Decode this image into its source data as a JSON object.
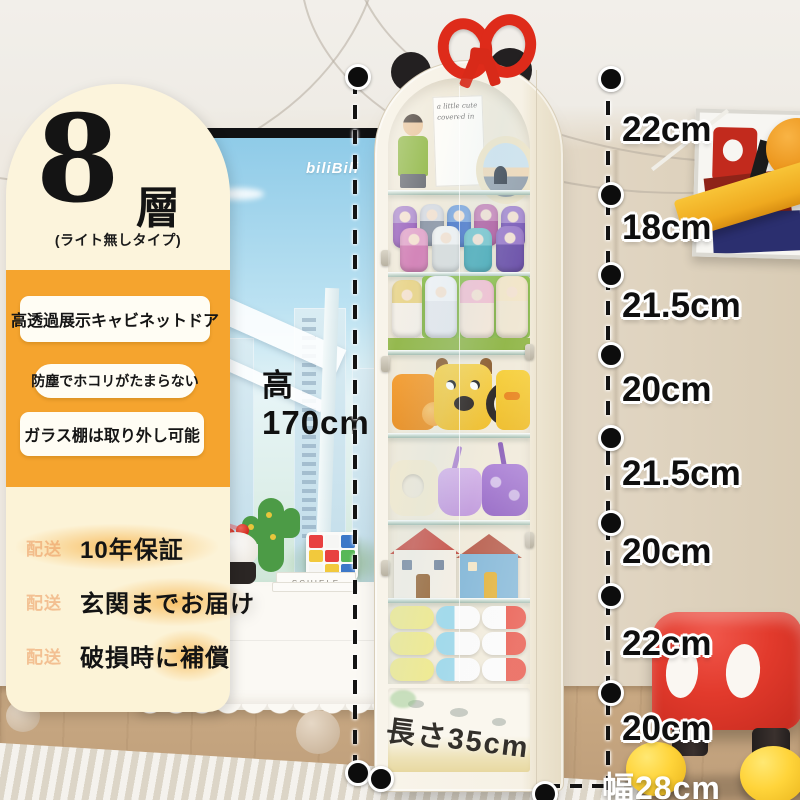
{
  "badge": {
    "tiers": "8層",
    "subtitle": "(ライト無しタイプ)"
  },
  "features": {
    "items": [
      {
        "label": "高透過展示キャビネットドア"
      },
      {
        "label": "防塵でホコリがたまらない"
      },
      {
        "label": "ガラス棚は取り外し可能"
      }
    ]
  },
  "services": {
    "items": [
      {
        "icon": "配送",
        "label": "10年保証"
      },
      {
        "icon": "配送",
        "label": "玄関までお届け"
      },
      {
        "icon": "配送",
        "label": "破損時に補償"
      }
    ]
  },
  "dimensions": {
    "height_prefix": "高",
    "height": "170cm",
    "depth": "長さ35cm",
    "width": "幅28cm",
    "segments": [
      {
        "label": "22cm"
      },
      {
        "label": "18cm"
      },
      {
        "label": "21.5cm"
      },
      {
        "label": "20cm"
      },
      {
        "label": "21.5cm"
      },
      {
        "label": "20cm"
      },
      {
        "label": "22cm"
      },
      {
        "label": "20cm"
      }
    ]
  },
  "scene": {
    "tv_logo": "biliBili",
    "book_spine": "SCHIELE",
    "card_text": "a little cute covered in"
  },
  "colors": {
    "accent_orange": "#F5A42E",
    "panel_cream": "#FCF3D7",
    "bow_red": "#DE2B1A",
    "stool_red": "#E23A2C",
    "shoe_yellow": "#FFD43A",
    "annotation_black": "#0F0F0F"
  }
}
